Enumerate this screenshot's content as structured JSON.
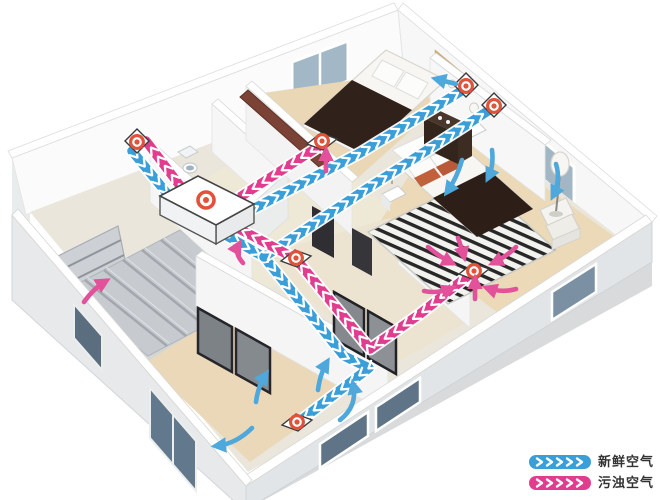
{
  "legend": {
    "items": [
      {
        "id": "fresh",
        "label": "新鲜空气",
        "color": "#3A9FD8"
      },
      {
        "id": "exhaust",
        "label": "污浊空气",
        "color": "#E13C8E"
      }
    ]
  },
  "palette": {
    "fresh_duct": "#3A9FD8",
    "exhaust_duct": "#E13C8E",
    "fresh_arrow": "#4FA8DC",
    "exhaust_arrow": "#E2519A",
    "vent_ring": "#E0523A",
    "chevron": "#FFFFFF"
  },
  "diagram": {
    "ducts": [
      {
        "name": "fresh-air-intake-duct",
        "type": "fresh",
        "points": [
          [
            132,
            151
          ],
          [
            170,
            197
          ]
        ]
      },
      {
        "name": "exhaust-outlet-duct",
        "type": "exhaust",
        "points": [
          [
            184,
            191
          ],
          [
            146,
            141
          ]
        ]
      },
      {
        "name": "fresh-air-trunk-duct",
        "type": "fresh",
        "points": [
          [
            222,
            233
          ],
          [
            264,
            257
          ],
          [
            344,
            356
          ],
          [
            369,
            368
          ],
          [
            300,
            421
          ]
        ]
      },
      {
        "name": "fresh-air-branch-bedroom1",
        "type": "fresh",
        "points": [
          [
            230,
            221
          ],
          [
            360,
            153
          ],
          [
            463,
            90
          ]
        ]
      },
      {
        "name": "fresh-air-branch-master",
        "type": "fresh",
        "points": [
          [
            264,
            257
          ],
          [
            362,
            192
          ],
          [
            491,
            109
          ]
        ]
      },
      {
        "name": "exhaust-branch-bedroom1",
        "type": "exhaust",
        "points": [
          [
            318,
            147
          ],
          [
            226,
            206
          ]
        ]
      },
      {
        "name": "exhaust-branch-master",
        "type": "exhaust",
        "points": [
          [
            474,
            271
          ],
          [
            420,
            314
          ],
          [
            370,
            349
          ],
          [
            296,
            259
          ],
          [
            230,
            224
          ]
        ]
      }
    ],
    "vents": [
      {
        "name": "outdoor-wall-vent",
        "mount": "wall",
        "x": 137,
        "y": 142
      },
      {
        "name": "bedroom1-exhaust-floor-vent",
        "mount": "floor",
        "x": 322,
        "y": 141
      },
      {
        "name": "bedroom1-supply-fan",
        "mount": "wall",
        "x": 466,
        "y": 86
      },
      {
        "name": "master-supply-fan",
        "mount": "wall",
        "x": 494,
        "y": 106
      },
      {
        "name": "hallway-exhaust-vent",
        "mount": "floor",
        "x": 296,
        "y": 258
      },
      {
        "name": "master-exhaust-floor-vent",
        "mount": "floor",
        "x": 474,
        "y": 271
      },
      {
        "name": "livingroom-supply-floor-vent",
        "mount": "floor",
        "x": 297,
        "y": 422
      }
    ],
    "unit": {
      "name": "heat-recovery-ventilator",
      "bullseye": [
        206,
        200
      ],
      "top": [
        [
          160,
          196
        ],
        [
          198,
          176
        ],
        [
          254,
          204
        ],
        [
          216,
          225
        ]
      ],
      "front": [
        [
          216,
          225
        ],
        [
          254,
          204
        ],
        [
          254,
          223
        ],
        [
          216,
          244
        ]
      ],
      "side": [
        [
          160,
          196
        ],
        [
          216,
          225
        ],
        [
          216,
          244
        ],
        [
          160,
          215
        ]
      ]
    },
    "flow_arrows": [
      {
        "type": "fresh",
        "pts": [
          [
            256,
            402
          ],
          [
            258,
            386
          ],
          [
            266,
            374
          ]
        ]
      },
      {
        "type": "fresh",
        "pts": [
          [
            318,
            390
          ],
          [
            320,
            374
          ],
          [
            327,
            362
          ]
        ]
      },
      {
        "type": "fresh",
        "pts": [
          [
            340,
            420
          ],
          [
            358,
            406
          ],
          [
            353,
            384
          ]
        ]
      },
      {
        "type": "fresh",
        "pts": [
          [
            252,
            428
          ],
          [
            236,
            444
          ],
          [
            216,
            446
          ]
        ]
      },
      {
        "type": "fresh",
        "pts": [
          [
            462,
            160
          ],
          [
            457,
            178
          ],
          [
            447,
            192
          ]
        ]
      },
      {
        "type": "fresh",
        "pts": [
          [
            492,
            150
          ],
          [
            494,
            166
          ],
          [
            488,
            178
          ]
        ]
      },
      {
        "type": "fresh",
        "pts": [
          [
            556,
            164
          ],
          [
            561,
            180
          ],
          [
            553,
            196
          ]
        ]
      },
      {
        "type": "fresh",
        "pts": [
          [
            456,
            84
          ],
          [
            436,
            79
          ]
        ]
      },
      {
        "type": "exhaust",
        "pts": [
          [
            326,
            171
          ],
          [
            326,
            151
          ]
        ]
      },
      {
        "type": "exhaust",
        "pts": [
          [
            475,
            299
          ],
          [
            475,
            279
          ]
        ]
      },
      {
        "type": "exhaust",
        "pts": [
          [
            428,
            247
          ],
          [
            440,
            257
          ],
          [
            452,
            263
          ]
        ]
      },
      {
        "type": "exhaust",
        "pts": [
          [
            458,
            238
          ],
          [
            462,
            249
          ],
          [
            464,
            257
          ]
        ]
      },
      {
        "type": "exhaust",
        "pts": [
          [
            516,
            247
          ],
          [
            506,
            257
          ],
          [
            493,
            263
          ]
        ]
      },
      {
        "type": "exhaust",
        "pts": [
          [
            424,
            291
          ],
          [
            438,
            294
          ],
          [
            452,
            288
          ]
        ]
      },
      {
        "type": "exhaust",
        "pts": [
          [
            516,
            289
          ],
          [
            502,
            293
          ],
          [
            487,
            288
          ]
        ]
      },
      {
        "type": "exhaust",
        "pts": [
          [
            84,
            302
          ],
          [
            94,
            288
          ],
          [
            106,
            281
          ]
        ]
      },
      {
        "type": "exhaust",
        "pts": [
          [
            243,
            263
          ],
          [
            234,
            253
          ],
          [
            239,
            244
          ]
        ]
      }
    ]
  }
}
